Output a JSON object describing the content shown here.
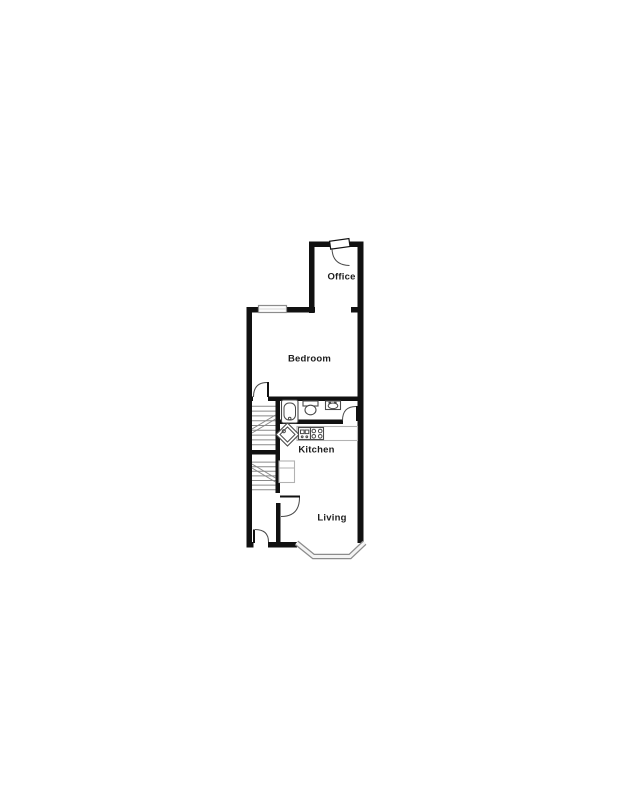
{
  "floor_plan": {
    "rooms": [
      {
        "id": "office",
        "label": "Office"
      },
      {
        "id": "bedroom",
        "label": "Bedroom"
      },
      {
        "id": "kitchen",
        "label": "Kitchen"
      },
      {
        "id": "living",
        "label": "Living"
      }
    ],
    "features": [
      "staircase-upper",
      "staircase-lower",
      "bathtub",
      "toilet",
      "wash-basin",
      "corner-sink",
      "kitchen-sink",
      "hob",
      "refrigerator",
      "bedroom-window",
      "bay-window",
      "office-door",
      "bedroom-door",
      "bathroom-door",
      "living-room-door",
      "front-door"
    ],
    "colors": {
      "wall": "#111111",
      "window-border": "#8c8c8c",
      "window-fill": "#f4f4f4",
      "fixture": "#4a4a4a",
      "counter": "#b2b2b2",
      "stair": "#8a8a8a",
      "label": "#1c1c1c",
      "background": "#ffffff"
    }
  }
}
